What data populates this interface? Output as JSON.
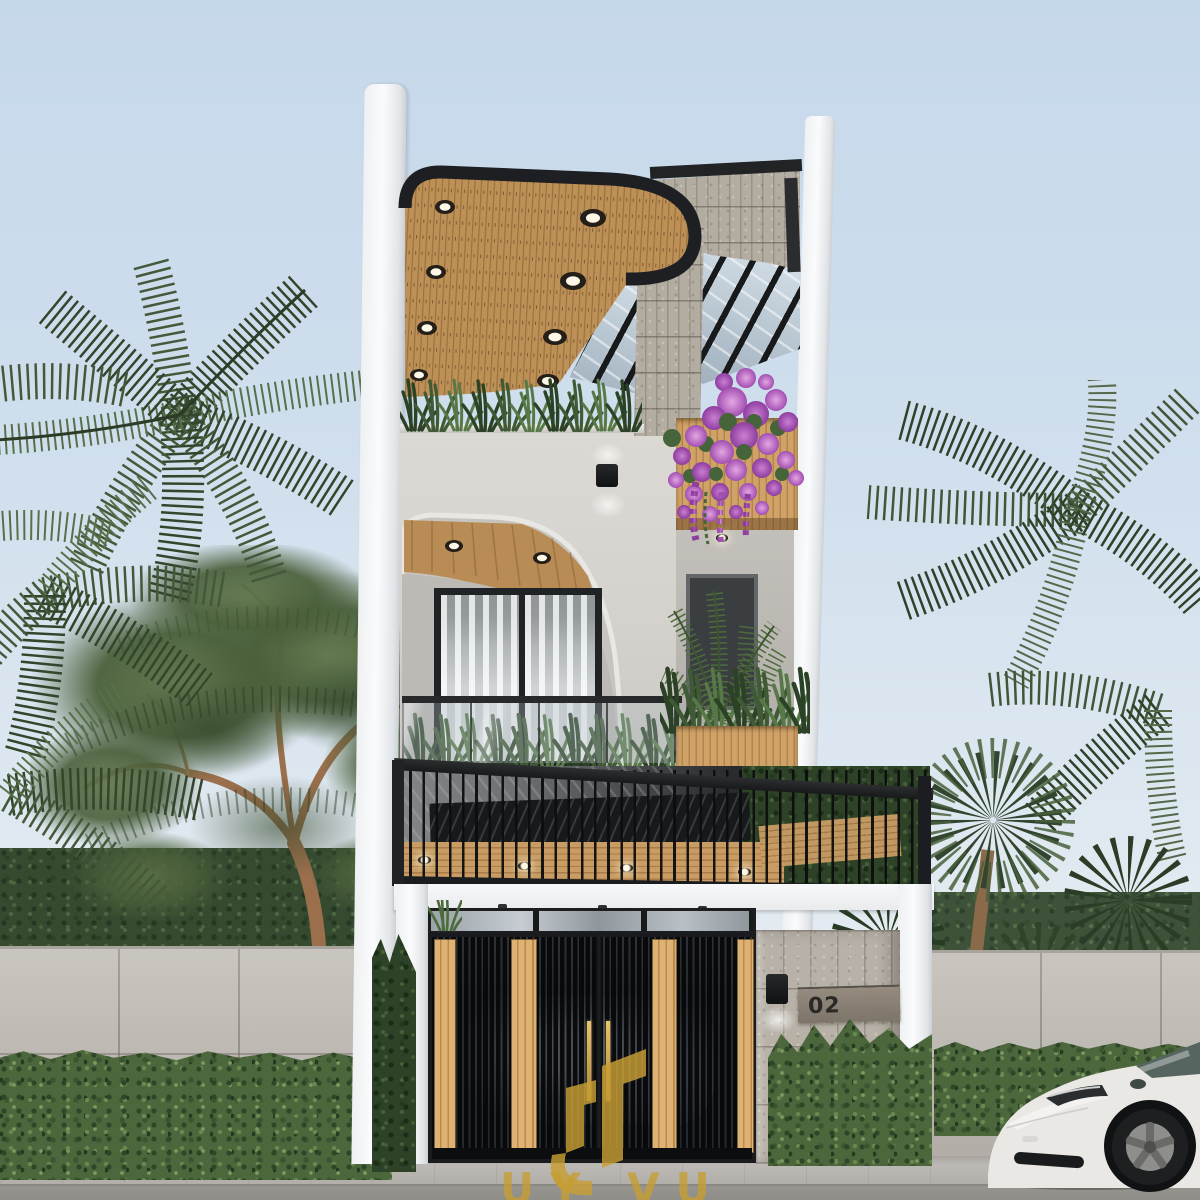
{
  "scene": {
    "type": "3D architectural exterior rendering",
    "setting": "modern three-storey narrow townhouse, street view, daytime, tropical landscaping",
    "house_number": "02",
    "watermark": {
      "logo": "gold stylized U monogram with upward arrow",
      "text": "UY VU"
    },
    "palette": {
      "sky_top": "#c5d8ea",
      "sky_bottom": "#ecf0f3",
      "wood": "#c1955f",
      "trim_black": "#1d1f22",
      "stucco": "#d6d3ce",
      "stone": "#b3aca1",
      "boundary_wall": "#bdb8b1",
      "hedge": "#4d673c",
      "gold_accent": "#c89f35",
      "road": "#918f8a",
      "car_white": "#e9e8e5",
      "bougainvillea": "#bd72c6"
    },
    "objects": [
      "palm trees",
      "deciduous tree",
      "boundary wall with hedge",
      "curved rooftop canopy with downlights",
      "stone-clad column and beam",
      "glass pergola",
      "bougainvillea planter",
      "arched balcony with sliding window",
      "glass balustrade",
      "black steel carport railing",
      "slatted entrance gate with wood strips",
      "gold gate handles",
      "stone pillar with wall lamp and number plaque",
      "white electric car",
      "sidewalk and road"
    ]
  }
}
